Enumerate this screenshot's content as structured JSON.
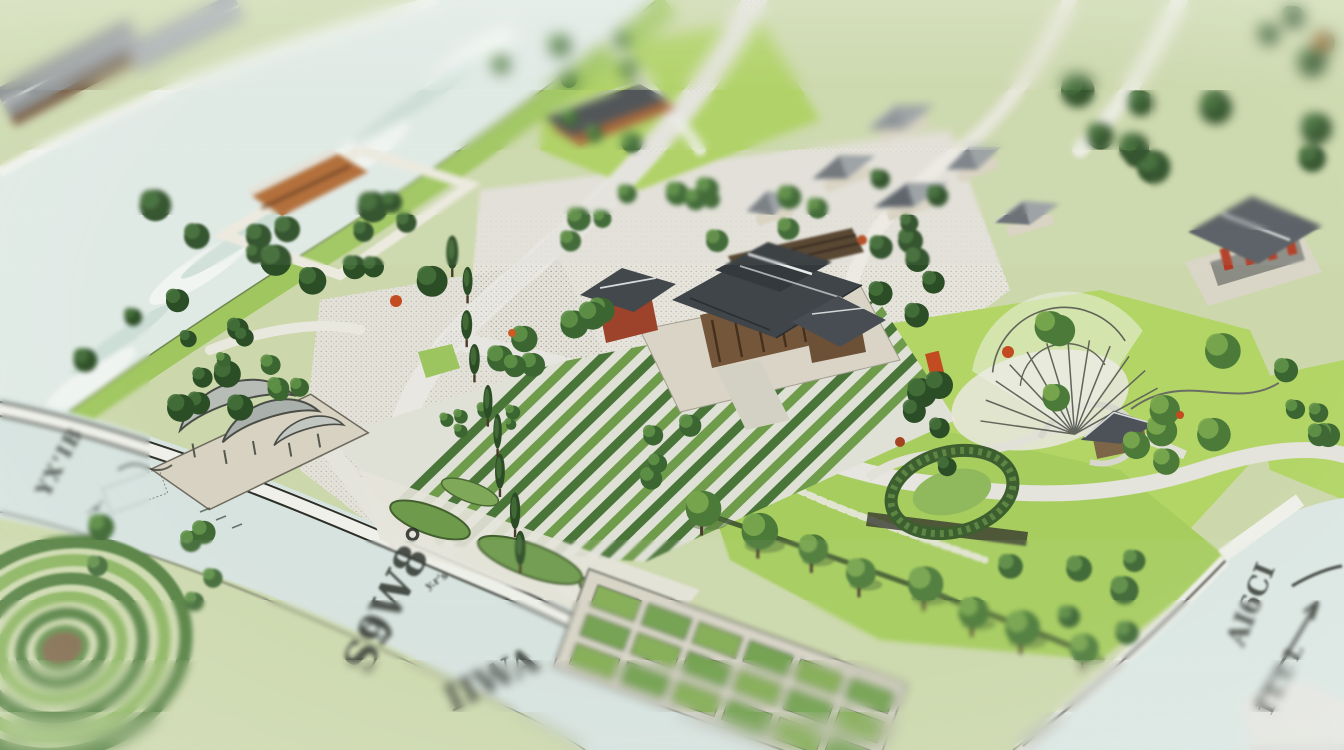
{
  "scene": {
    "description": "Tilt-shift style photograph of an illustrated site-plan map of a traditional village with rivers, orchards, gardens and hanok-style buildings",
    "palette": {
      "water": "#dfe9e4",
      "canal_water": "#d6e3df",
      "gravel": "#e6e4db",
      "grass_bright": "#b3d566",
      "grass_mid": "#a5ca60",
      "foliage_dark": "#2c4e26",
      "foliage_mid": "#3c6631",
      "road": "#e8e7e1",
      "roof_gray": "#474d52",
      "roof_red_brown": "#b06a33",
      "wall_brown": "#74563a",
      "accent_red": "#c24b22",
      "ink": "#2b302a"
    },
    "labels": [
      {
        "id": "river-label-upper-left",
        "text": "YX'IB",
        "rotation_deg": -62
      },
      {
        "id": "canal-label-large",
        "text": "S9W8°",
        "rotation_deg": -63
      },
      {
        "id": "canal-label-lower",
        "text": "IIWA",
        "rotation_deg": -26
      },
      {
        "id": "pond-label-right",
        "text": "AI6CI",
        "rotation_deg": -68
      },
      {
        "id": "pond-mark-right",
        "text": "1LLL",
        "rotation_deg": -64
      },
      {
        "id": "canal-scribble-small",
        "text": "y.r's",
        "rotation_deg": -32
      },
      {
        "id": "riverbank-micro-scribble",
        "text": "~w''",
        "rotation_deg": -30
      }
    ]
  }
}
